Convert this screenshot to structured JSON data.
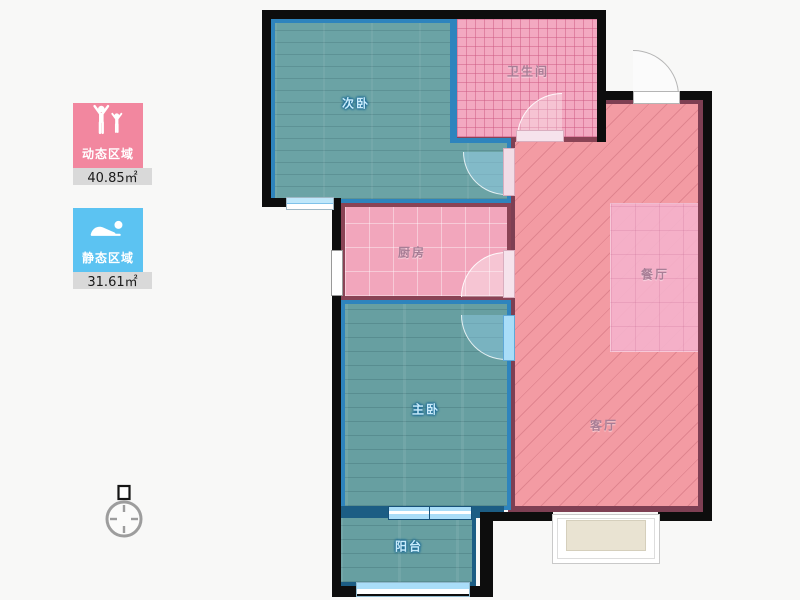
{
  "legend": {
    "dynamic": {
      "label": "动态区域",
      "value": "40.85㎡",
      "color": "#f2879f",
      "icon": "cheering-people-icon"
    },
    "static": {
      "label": "静态区域",
      "value": "31.61㎡",
      "color": "#5cc3f2",
      "icon": "sleeping-person-icon"
    }
  },
  "rooms": {
    "second_bedroom": {
      "label": "次卧"
    },
    "bathroom": {
      "label": "卫生间"
    },
    "kitchen": {
      "label": "厨房"
    },
    "dining": {
      "label": "餐厅"
    },
    "master_bedroom": {
      "label": "主卧"
    },
    "living": {
      "label": "客厅"
    },
    "balcony": {
      "label": "阳台"
    }
  },
  "icons": {
    "compass": "compass-icon"
  },
  "colors": {
    "legend_dynamic": "#f2879f",
    "legend_static": "#5cc3f2",
    "value_strip": "#d9d9d9",
    "wall_black": "#0d0d0d",
    "wall_maroon": "#7e3f53",
    "wall_blue": "#2e84bd",
    "floor_teal": "#6ba3a5",
    "floor_pink": "#f39ba3",
    "kitchen_pink": "#f2a6bc",
    "bathroom_pink": "#f3a9c1",
    "dining_pink": "#f4b2ca",
    "door_glass_blue": "#a9ddf8",
    "bay_window_fill": "#e9e3d2"
  }
}
